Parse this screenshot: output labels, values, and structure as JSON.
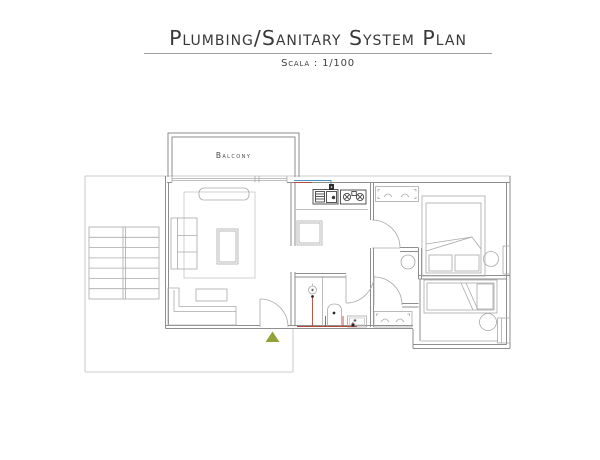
{
  "header": {
    "title": "Plumbing/Sanitary System Plan",
    "subtitle": "Scala : 1/100"
  },
  "plan": {
    "labels": {
      "balcony": "Balcony"
    },
    "colors": {
      "pipe_cold": "#4a90c4",
      "pipe_hot": "#b5473d",
      "entry_marker": "#8fa33a"
    }
  }
}
